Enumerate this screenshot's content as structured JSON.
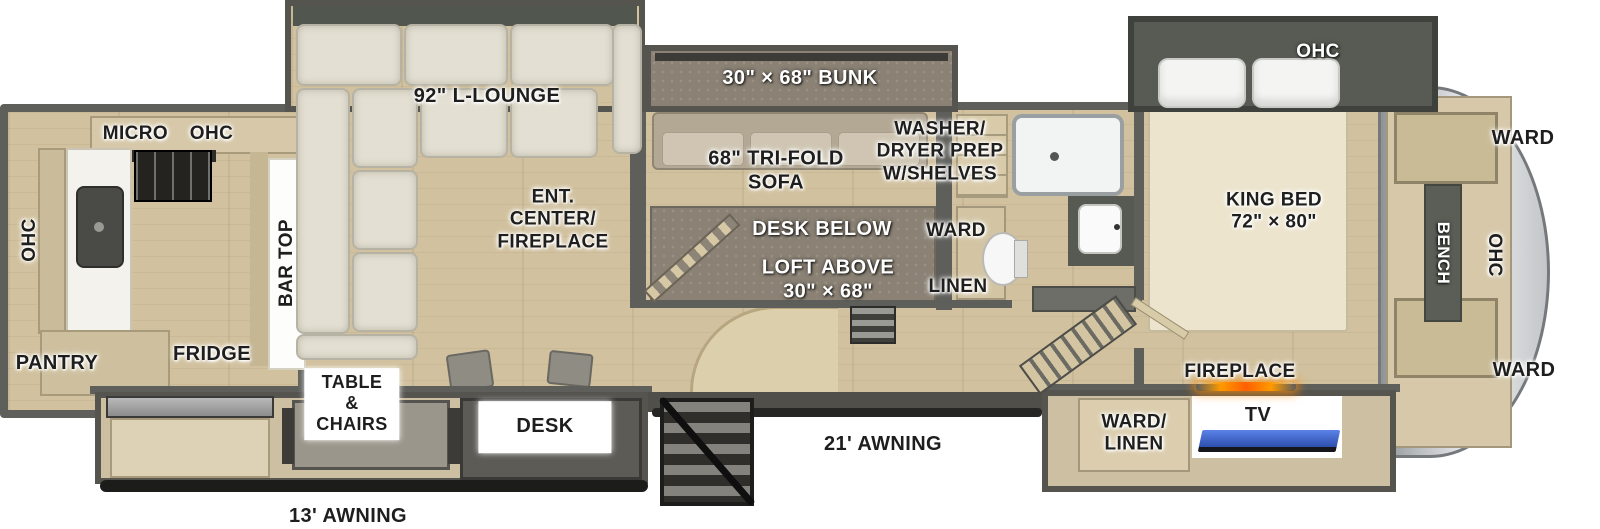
{
  "areas": {
    "kitchen": {
      "micro_ohc": "MICRO OHC",
      "ohc": "OHC",
      "bar_top": "BAR TOP",
      "pantry": "PANTRY",
      "fridge": "FRIDGE"
    },
    "living": {
      "l_lounge": "92\" L-LOUNGE",
      "ent_center": "ENT.\nCENTER/\nFIREPLACE",
      "tri_fold_sofa": "68\" TRI-FOLD\nSOFA"
    },
    "bunk_room": {
      "bunk": "30\" × 68\" BUNK",
      "desk_below": "DESK BELOW",
      "loft_above": "LOFT ABOVE\n30\" × 68\"",
      "washer_dryer": "WASHER/\nDRYER PREP\nW/SHELVES",
      "ward": "WARD",
      "linen": "LINEN"
    },
    "bedroom": {
      "ohc": "OHC",
      "king_bed": "KING BED\n72\" × 80\"",
      "fireplace": "FIREPLACE"
    },
    "rear_cap": {
      "ward_top": "WARD",
      "ohc": "OHC",
      "bench": "BENCH",
      "ward_bottom": "WARD"
    },
    "door_side": {
      "table_chairs": "TABLE\n&\nCHAIRS",
      "desk": "DESK",
      "ward_linen": "WARD/\nLINEN",
      "tv": "TV",
      "awning_21": "21' AWNING",
      "awning_13": "13' AWNING"
    }
  },
  "colors": {
    "floor_wood": "#d1c19e",
    "wall_gray": "#5e5e5a",
    "slide_olive": "#575b53",
    "carpet_gray": "#8b8275",
    "sofa_cream": "#e3dfd2",
    "counter_tan": "#d6c8a8",
    "cap_silver": "#c3c6c8",
    "tv_screen": "#3d6cd8",
    "fireplace_glow": "#ff7a00",
    "text_dark": "#1e1e1e",
    "text_light": "#ffffff"
  }
}
